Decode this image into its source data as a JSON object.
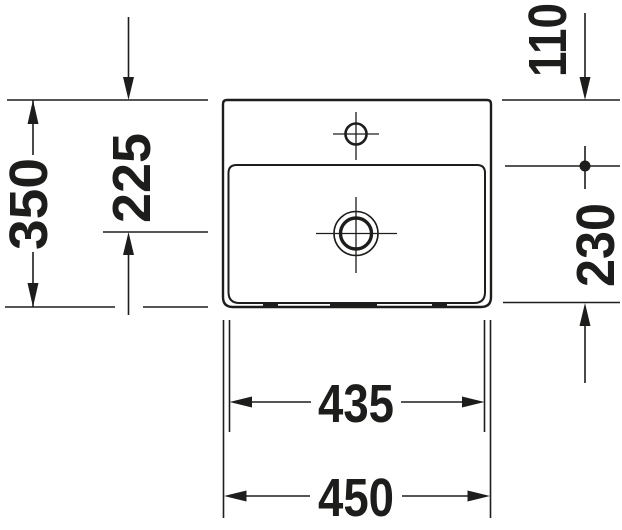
{
  "drawing": {
    "type": "washbasin-top-view-technical-drawing",
    "colors": {
      "line": "#1d1d1b",
      "background": "#ffffff",
      "text": "#1d1d1b"
    },
    "dimension_labels": {
      "left_outer": "350",
      "left_inner": "225",
      "right_top": "110",
      "right_bottom": "230",
      "bottom_inner": "435",
      "bottom_outer": "450"
    },
    "features": {
      "basin_outline": "basin-outer-outline",
      "bowl_outline": "basin-bowl-outline",
      "faucet_hole": "faucet-hole-with-centerlines",
      "drain": "drain-with-centerlines"
    }
  }
}
